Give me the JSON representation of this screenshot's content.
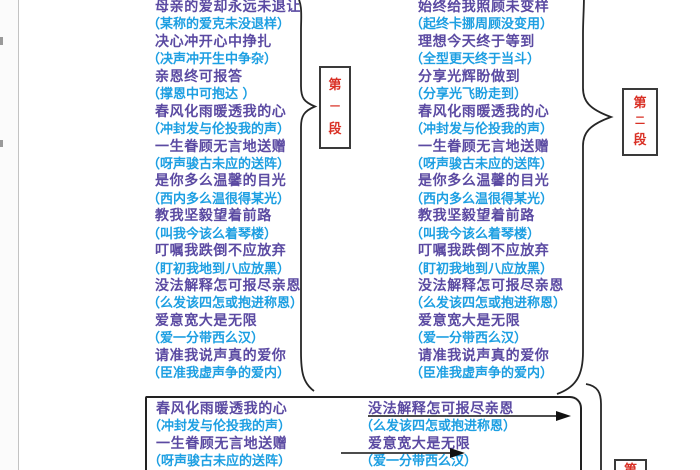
{
  "colors": {
    "lyric": "#5b4aa2",
    "pron": "#1d9fe2",
    "label": "#d93025",
    "line": "#262626"
  },
  "annotations": {
    "section1_label": "第一段",
    "section2_label": "第二段",
    "section3_label_partial": "第"
  },
  "columns": {
    "left": {
      "lines": [
        {
          "type": "lyric",
          "text": "母亲的爱却永远未退让"
        },
        {
          "type": "pron",
          "text": "（某称的爱克未没退样）"
        },
        {
          "type": "lyric",
          "text": "决心冲开心中挣扎"
        },
        {
          "type": "pron",
          "text": "（决声冲开生中争杂）"
        },
        {
          "type": "lyric",
          "text": "亲恩终可报答"
        },
        {
          "type": "pron",
          "text": "（撑恩中可抱达 ）"
        },
        {
          "type": "lyric",
          "text": "春风化雨暖透我的心"
        },
        {
          "type": "pron",
          "text": "（冲封发与伦投我的声）"
        },
        {
          "type": "lyric",
          "text": "一生眷顾无言地送赠"
        },
        {
          "type": "pron",
          "text": "（呀声骏古未应的送阵）"
        },
        {
          "type": "lyric",
          "text": "是你多么温馨的目光"
        },
        {
          "type": "pron",
          "text": "（西内多么温很得某光）"
        },
        {
          "type": "lyric",
          "text": "教我坚毅望着前路"
        },
        {
          "type": "pron",
          "text": "（叫我今该么着琴楼）"
        },
        {
          "type": "lyric",
          "text": "叮嘱我跌倒不应放弃"
        },
        {
          "type": "pron",
          "text": "（盯初我地到八应放黑）"
        },
        {
          "type": "lyric",
          "text": "没法解释怎可报尽亲恩"
        },
        {
          "type": "pron",
          "text": "（么发该四怎或抱进称恩）"
        },
        {
          "type": "lyric",
          "text": "爱意宽大是无限"
        },
        {
          "type": "pron",
          "text": "（爱一分带西么汉）"
        },
        {
          "type": "lyric",
          "text": "请准我说声真的爱你"
        },
        {
          "type": "pron",
          "text": "（臣准我虚声争的爱内）"
        }
      ]
    },
    "right": {
      "lines": [
        {
          "type": "lyric",
          "text": "始终给我照顾未变样"
        },
        {
          "type": "pron",
          "text": "（起终卡挪周顾没变用）"
        },
        {
          "type": "lyric",
          "text": "理想今天终于等到"
        },
        {
          "type": "pron",
          "text": "（全型更天终于当斗）"
        },
        {
          "type": "lyric",
          "text": "分享光辉盼做到"
        },
        {
          "type": "pron",
          "text": "（分享光飞盼走到）"
        },
        {
          "type": "lyric",
          "text": "春风化雨暖透我的心"
        },
        {
          "type": "pron",
          "text": "（冲封发与伦投我的声）"
        },
        {
          "type": "lyric",
          "text": "一生眷顾无言地送赠"
        },
        {
          "type": "pron",
          "text": "（呀声骏古未应的送阵）"
        },
        {
          "type": "lyric",
          "text": "是你多么温馨的目光"
        },
        {
          "type": "pron",
          "text": "（西内多么温很得某光）"
        },
        {
          "type": "lyric",
          "text": "教我坚毅望着前路"
        },
        {
          "type": "pron",
          "text": "（叫我今该么着琴楼）"
        },
        {
          "type": "lyric",
          "text": "叮嘱我跌倒不应放弃"
        },
        {
          "type": "pron",
          "text": "（盯初我地到八应放黑）"
        },
        {
          "type": "lyric",
          "text": "没法解释怎可报尽亲恩"
        },
        {
          "type": "pron",
          "text": "（么发该四怎或抱进称恩）"
        },
        {
          "type": "lyric",
          "text": "爱意宽大是无限"
        },
        {
          "type": "pron",
          "text": "（爱一分带西么汉）"
        },
        {
          "type": "lyric",
          "text": "请准我说声真的爱你"
        },
        {
          "type": "pron",
          "text": "（臣准我虚声争的爱内）"
        }
      ]
    },
    "bottom_left": {
      "lines": [
        {
          "type": "lyric",
          "text": "春风化雨暖透我的心"
        },
        {
          "type": "pron",
          "text": "（冲封发与伦投我的声）"
        },
        {
          "type": "lyric",
          "text": "一生眷顾无言地送赠"
        },
        {
          "type": "pron",
          "text": "（呀声骏古未应的送阵）"
        }
      ]
    },
    "bottom_right": {
      "lines": [
        {
          "type": "lyric",
          "text": "没法解释怎可报尽亲恩"
        },
        {
          "type": "pron",
          "text": "（么发该四怎或抱进称恩）"
        },
        {
          "type": "lyric",
          "text": "爱意宽大是无限"
        },
        {
          "type": "pron",
          "text": "（爱一分带西么汉）"
        }
      ]
    }
  }
}
